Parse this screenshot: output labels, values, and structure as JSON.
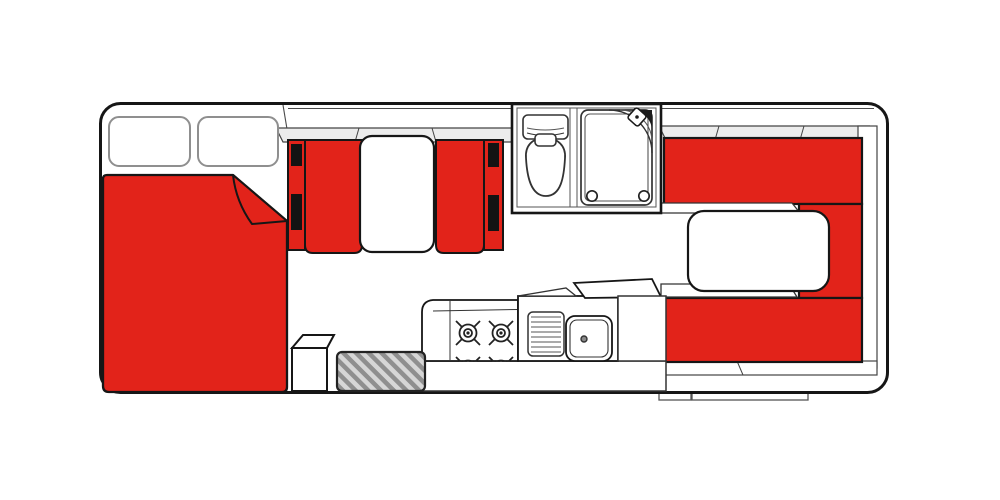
{
  "page": {
    "description": "Top-down motorhome camper floor plan with red upholstery highlights",
    "background": "#ffffff"
  },
  "colors": {
    "upholstery_red": "#e2231a",
    "outline_dark": "#161616",
    "wall_line_gray": "#4a4a4a",
    "trim_gray": "#ececec",
    "pillow_gray": "#8f8f8f",
    "belt_black": "#131313",
    "mat_stripe_dark": "#8f8f8f",
    "mat_stripe_light": "#d6d6d6",
    "fixture_white": "#ffffff"
  },
  "areas": {
    "cab_bed": {
      "pillow_count": 2,
      "features": [
        "double-bed",
        "folded-blanket-corner"
      ]
    },
    "front_dinette": {
      "seat_count": 2,
      "seatbelt_count": 4,
      "features": [
        "forward-seat",
        "rear-facing-seat",
        "table"
      ]
    },
    "bathroom": {
      "features": [
        "toilet-cistern",
        "toilet-bowl",
        "shower-tray",
        "shower-head",
        "drain-caps"
      ]
    },
    "kitchen": {
      "burner_count": 4,
      "features": [
        "stove",
        "drainboard",
        "sink",
        "tap",
        "angled-counter"
      ]
    },
    "rear_lounge": {
      "seat_count": 3,
      "features": [
        "u-shaped-seating",
        "table"
      ]
    },
    "entry": {
      "features": [
        "step-box",
        "door-mat"
      ]
    },
    "exterior": {
      "underbody_hatch_count": 2
    }
  },
  "icons": [
    "shower-head-icon",
    "stove-burner-icon",
    "sink-tap-icon",
    "seatbelt-icon",
    "toilet-icon"
  ]
}
